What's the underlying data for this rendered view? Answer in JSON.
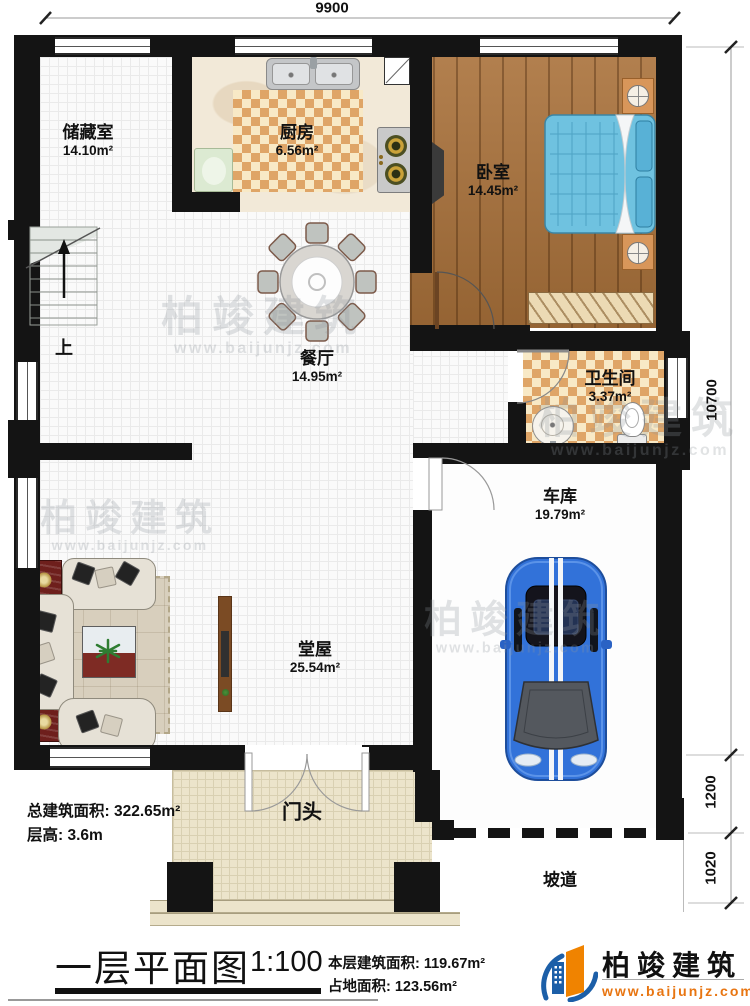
{
  "dimensions": {
    "top_width": "9900",
    "right_total": "10700",
    "right_mid": "1200",
    "right_lower": "1020"
  },
  "rooms": {
    "storage": {
      "name": "储藏室",
      "area": "14.10m²"
    },
    "kitchen": {
      "name": "厨房",
      "area": "6.56m²"
    },
    "bedroom": {
      "name": "卧室",
      "area": "14.45m²"
    },
    "dining": {
      "name": "餐厅",
      "area": "14.95m²"
    },
    "bathroom": {
      "name": "卫生间",
      "area": "3.37m²"
    },
    "garage": {
      "name": "车库",
      "area": "19.79m²"
    },
    "hall": {
      "name": "堂屋",
      "area": "25.54m²"
    },
    "porch": {
      "name": "门头"
    },
    "ramp": {
      "name": "坡道"
    }
  },
  "stairs": {
    "up_label": "上"
  },
  "annotations": {
    "total_build_area": "总建筑面积: 322.65m²",
    "floor_height": "层高: 3.6m"
  },
  "title_block": {
    "drawing_name": "一层平面图",
    "scale": "1:100",
    "this_floor_area": "本层建筑面积: 119.67m²",
    "land_area": "占地面积: 123.56m²"
  },
  "brand": {
    "name": "柏竣建筑",
    "website": "www.baijunjz.com"
  },
  "watermark": {
    "name": "柏竣建筑",
    "website": "www.baijunjz.com"
  },
  "colors": {
    "wall": "#141414",
    "wood_floor": "#a9713a",
    "checker_tile": "#dfa567",
    "bed_blue": "#6fc2e0",
    "car_blue": "#3272d9",
    "logo_orange": "#f08300",
    "logo_blue": "#1c5fa8"
  }
}
